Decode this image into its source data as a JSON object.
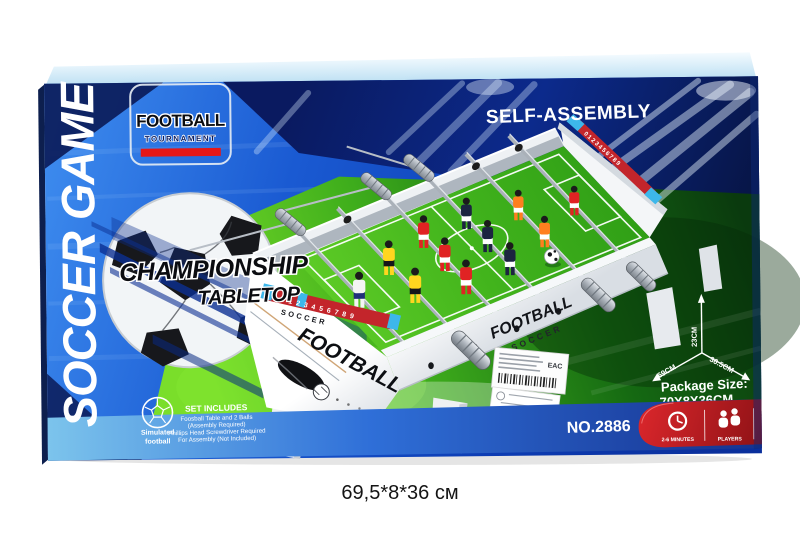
{
  "caption": "69,5*8*36 см",
  "panel": {
    "side_vertical": "SOCCER GAME",
    "badge": {
      "title": "FOOTBALL",
      "subtitle": "TOURNAMENT"
    },
    "tagline": {
      "line1": "CHAMPIONSHIP",
      "line2": "TABLETOP"
    },
    "self_assembly": "SELF-ASSEMBLY",
    "model_no": "NO.2886",
    "package": {
      "label": "Package Size:",
      "value": "70X8X36CM"
    },
    "dims": {
      "height": "23CM",
      "length": "69CM",
      "depth": "36.5CM"
    },
    "set_includes": {
      "title": "SET INCLUDES",
      "lines": [
        "Foosball Table and 2 Balls",
        "(Assembly Required)",
        "Phillips Head Screwdriver Required",
        "For Assembly (Not Included)"
      ]
    },
    "simulated": {
      "line1": "Simulated",
      "line2": "football"
    },
    "info_badges": {
      "minutes": "2-6 MINUTES",
      "players_count": "2",
      "players": "PLAYERS"
    },
    "sticker": {
      "cert": "EAC"
    }
  },
  "table": {
    "front_title": "FOOTBALL",
    "front_small": "SOCCER",
    "side_title": "FOOTBALL",
    "side_subtitle": "SOCCER",
    "score_digits": "0123456789"
  },
  "colors": {
    "box_blue": "#1558cc",
    "stadium_navy": "#0a1f6e",
    "pitch_green": "#45b81e",
    "accent_red": "#cf1d22",
    "score_red": "#c3252b",
    "slider_blue": "#3db7ea",
    "teams": {
      "red": "#e02323",
      "yellow": "#ffd61f",
      "navy": "#1c2440",
      "white": "#f4f4f4",
      "orange": "#ff7f1f"
    }
  }
}
